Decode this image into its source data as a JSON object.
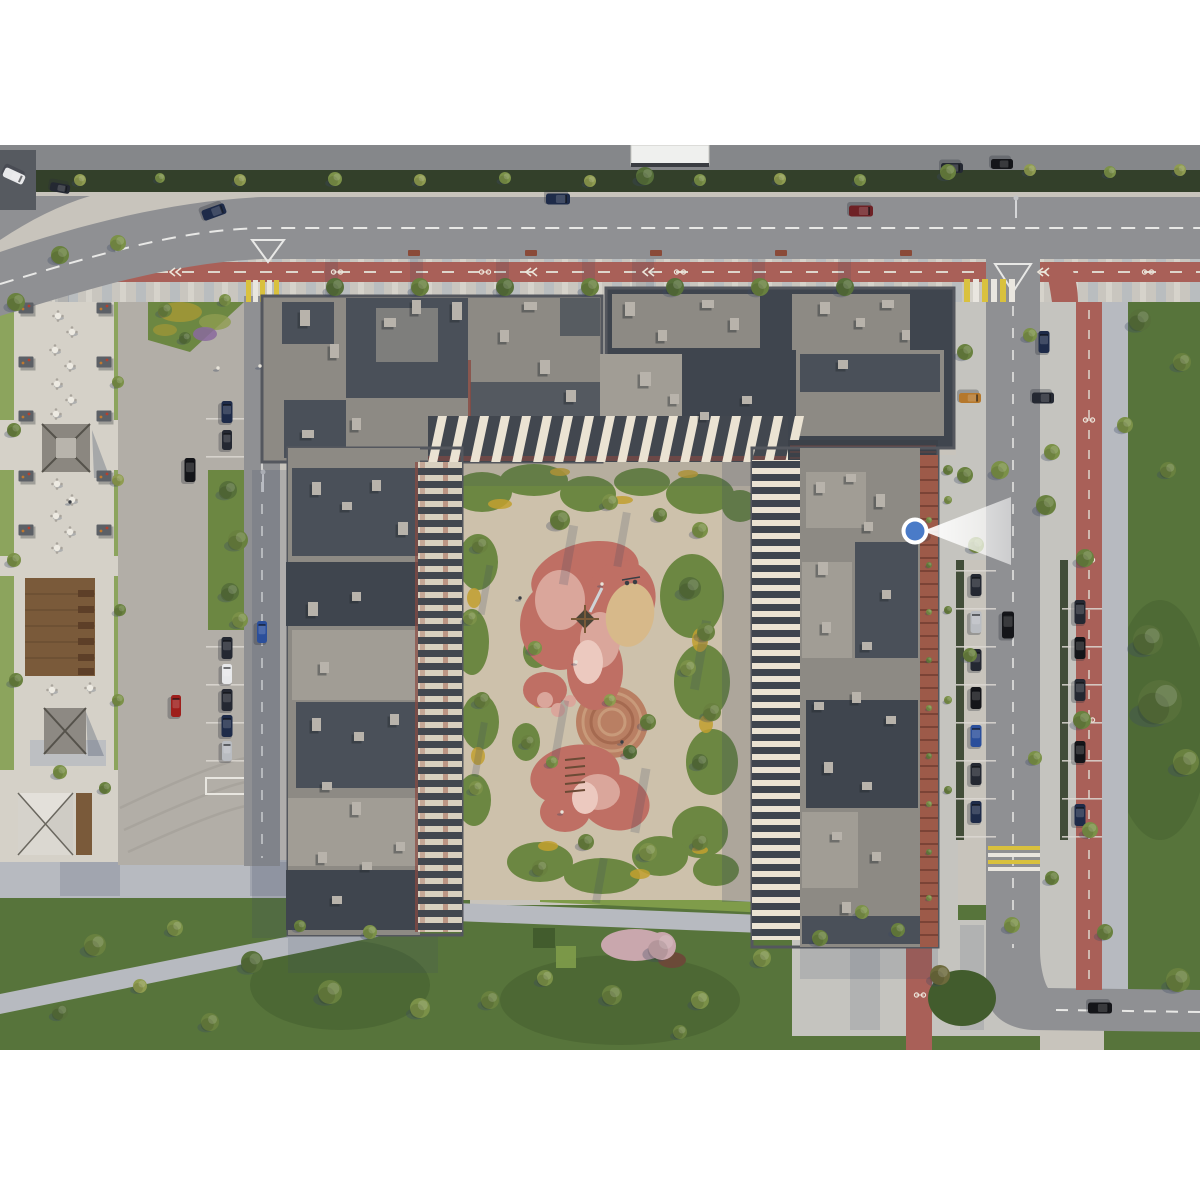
{
  "viewpoint_marker": {
    "x": 915,
    "y": 531,
    "cone_length": 92,
    "color_key": "markerBlue",
    "ring_key": "white"
  },
  "colors": {
    "white": "#ffffff",
    "ground": "#c8c4bc",
    "plaza": "#d5d1c8",
    "apron": "#b2aea7",
    "apronArc": "#a4a099",
    "asphalt": "#8f9093",
    "asphalt2": "#85878a",
    "roadline": "#e8e8e6",
    "stoneA": "#c9c6bf",
    "stoneB": "#b3b9c0",
    "stoneC": "#d6d3cb",
    "stone": "#b7bac0",
    "stoneL": "#c5c4bf",
    "bike": "#a96058",
    "court": "#cdc1ab",
    "lawn": "#57743b",
    "lawn2": "#6c8742",
    "lawnD": "#425c2d",
    "hedge": "#33402a",
    "hedge2": "#7f9c4a",
    "flower": "#c2a02f",
    "purple": "#8a6a9e",
    "blossom": "#c9a7ad",
    "mulch": "#6b4a38",
    "roofA": "#8d8a84",
    "roofD": "#4a5059",
    "roofD2": "#3f454e",
    "roofM": "#a19d95",
    "unit": "#b8b3ab",
    "parapet": "#54575e",
    "cream": "#ebe3d3",
    "facdark": "#42474f",
    "redline": "#8a4a42",
    "brickc": "#9d5a49",
    "brickd": "#7b4336",
    "wood": "#7a5a3a",
    "woodD": "#5d3f28",
    "sand": "#d7b98a",
    "rubber": "#bf6f64",
    "rubberP": "#daa69b",
    "rubberL": "#ecc9bf",
    "circ": "#b97f63",
    "shadow": "#3c4a63",
    "zebraY": "#d9c13e",
    "zebraW": "#e9e6df",
    "markerBlue": "#4a7bc8",
    "carDark": "#242832",
    "carBlack": "#141519",
    "carNavy": "#1e2b49",
    "carBlue": "#2b4f9b",
    "carWhite": "#e7e8ea",
    "carRed": "#9e1f1c",
    "carDkRed": "#6e2125",
    "carSilver": "#b9bcc1",
    "carOrange": "#b5782c",
    "tree1": "#57703a",
    "tree2": "#69813f",
    "tree3": "#7b9148",
    "tree4": "#8f9c50",
    "treeO": "#6d6a3c",
    "bench": "#8a4a38",
    "tableTop": "#edeae2",
    "chair": "#a9a49c",
    "pergola": "#5c6066",
    "person": "#e8e4da"
  },
  "scene": {
    "trees": [
      [
        80,
        180,
        6,
        "tree4"
      ],
      [
        160,
        178,
        5,
        "tree3"
      ],
      [
        240,
        180,
        6,
        "tree4"
      ],
      [
        335,
        179,
        7,
        "tree3"
      ],
      [
        420,
        180,
        6,
        "tree4"
      ],
      [
        505,
        178,
        6,
        "tree3"
      ],
      [
        590,
        181,
        6,
        "tree4"
      ],
      [
        645,
        176,
        9,
        "tree1"
      ],
      [
        700,
        180,
        6,
        "tree3"
      ],
      [
        780,
        179,
        6,
        "tree4"
      ],
      [
        860,
        180,
        6,
        "tree3"
      ],
      [
        948,
        172,
        8,
        "tree2"
      ],
      [
        1030,
        170,
        6,
        "tree4"
      ],
      [
        1110,
        172,
        6,
        "tree3"
      ],
      [
        1180,
        170,
        6,
        "tree4"
      ],
      [
        335,
        287,
        9,
        "tree1"
      ],
      [
        420,
        287,
        9,
        "tree2"
      ],
      [
        505,
        287,
        9,
        "tree1"
      ],
      [
        590,
        287,
        9,
        "tree2"
      ],
      [
        675,
        287,
        9,
        "tree1"
      ],
      [
        760,
        287,
        9,
        "tree2"
      ],
      [
        845,
        287,
        9,
        "tree1"
      ],
      [
        60,
        255,
        9,
        "tree2"
      ],
      [
        118,
        243,
        8,
        "tree3"
      ],
      [
        16,
        302,
        9,
        "tree2"
      ],
      [
        165,
        310,
        7,
        "tree2"
      ],
      [
        225,
        300,
        6,
        "tree3"
      ],
      [
        185,
        338,
        6,
        "tree1"
      ],
      [
        118,
        382,
        6,
        "tree3"
      ],
      [
        14,
        430,
        7,
        "tree2"
      ],
      [
        118,
        480,
        6,
        "tree4"
      ],
      [
        14,
        560,
        7,
        "tree3"
      ],
      [
        120,
        610,
        6,
        "tree2"
      ],
      [
        16,
        680,
        7,
        "tree2"
      ],
      [
        118,
        700,
        6,
        "tree3"
      ],
      [
        60,
        772,
        7,
        "tree3"
      ],
      [
        105,
        788,
        6,
        "tree2"
      ],
      [
        228,
        490,
        9,
        "tree1"
      ],
      [
        238,
        540,
        10,
        "tree2"
      ],
      [
        230,
        592,
        9,
        "tree1"
      ],
      [
        240,
        620,
        8,
        "tree3"
      ],
      [
        965,
        352,
        8,
        "tree2"
      ],
      [
        1030,
        335,
        7,
        "tree3"
      ],
      [
        1140,
        320,
        11,
        "tree1"
      ],
      [
        1182,
        362,
        9,
        "tree2"
      ],
      [
        1125,
        425,
        8,
        "tree3"
      ],
      [
        1168,
        470,
        8,
        "tree2"
      ],
      [
        1046,
        505,
        10,
        "tree2"
      ],
      [
        1052,
        452,
        8,
        "tree3"
      ],
      [
        965,
        475,
        8,
        "tree2"
      ],
      [
        1000,
        470,
        9,
        "tree3"
      ],
      [
        1085,
        558,
        9,
        "tree2"
      ],
      [
        1148,
        640,
        15,
        "tree1"
      ],
      [
        1160,
        702,
        22,
        "tree1"
      ],
      [
        1186,
        762,
        13,
        "tree2"
      ],
      [
        1082,
        720,
        9,
        "tree2"
      ],
      [
        1090,
        830,
        8,
        "tree3"
      ],
      [
        1052,
        878,
        7,
        "tree2"
      ],
      [
        976,
        545,
        8,
        "tree3"
      ],
      [
        970,
        655,
        7,
        "tree2"
      ],
      [
        1035,
        758,
        7,
        "tree3"
      ],
      [
        1178,
        980,
        12,
        "tree2"
      ],
      [
        1012,
        925,
        8,
        "tree3"
      ],
      [
        940,
        975,
        10,
        "treeO"
      ],
      [
        898,
        930,
        7,
        "tree2"
      ],
      [
        1105,
        932,
        8,
        "tree2"
      ],
      [
        862,
        912,
        7,
        "tree3"
      ],
      [
        95,
        945,
        11,
        "tree2"
      ],
      [
        175,
        928,
        8,
        "tree3"
      ],
      [
        252,
        962,
        11,
        "tree1"
      ],
      [
        330,
        992,
        12,
        "tree2"
      ],
      [
        420,
        1008,
        10,
        "tree3"
      ],
      [
        210,
        1022,
        9,
        "tree2"
      ],
      [
        60,
        1012,
        8,
        "tree1"
      ],
      [
        140,
        986,
        7,
        "tree4"
      ],
      [
        370,
        932,
        7,
        "tree3"
      ],
      [
        300,
        926,
        6,
        "tree2"
      ],
      [
        490,
        1000,
        9,
        "tree2"
      ],
      [
        545,
        978,
        8,
        "tree3"
      ],
      [
        612,
        995,
        10,
        "tree2"
      ],
      [
        700,
        1000,
        9,
        "tree3"
      ],
      [
        762,
        958,
        9,
        "tree3"
      ],
      [
        820,
        938,
        8,
        "tree2"
      ],
      [
        680,
        1032,
        7,
        "tree2"
      ],
      [
        662,
        946,
        14,
        "blossom"
      ],
      [
        560,
        520,
        10,
        "tree2"
      ],
      [
        610,
        502,
        8,
        "tree3"
      ],
      [
        660,
        515,
        7,
        "tree2"
      ],
      [
        700,
        530,
        8,
        "tree3"
      ],
      [
        480,
        545,
        8,
        "tree2"
      ],
      [
        470,
        618,
        7,
        "tree3"
      ],
      [
        482,
        700,
        8,
        "tree2"
      ],
      [
        476,
        788,
        7,
        "tree3"
      ],
      [
        690,
        588,
        11,
        "tree1"
      ],
      [
        706,
        632,
        9,
        "tree2"
      ],
      [
        688,
        668,
        8,
        "tree3"
      ],
      [
        712,
        712,
        9,
        "tree2"
      ],
      [
        700,
        762,
        8,
        "tree1"
      ],
      [
        535,
        648,
        7,
        "tree3"
      ],
      [
        528,
        742,
        7,
        "tree2"
      ],
      [
        552,
        762,
        6,
        "tree3"
      ],
      [
        648,
        722,
        8,
        "tree2"
      ],
      [
        630,
        752,
        7,
        "tree1"
      ],
      [
        586,
        842,
        8,
        "tree2"
      ],
      [
        648,
        852,
        9,
        "tree3"
      ],
      [
        540,
        868,
        8,
        "tree2"
      ],
      [
        700,
        842,
        8,
        "tree2"
      ],
      [
        610,
        700,
        6,
        "tree4"
      ],
      [
        929,
        520,
        3,
        "tree3"
      ],
      [
        929,
        565,
        3,
        "tree2"
      ],
      [
        929,
        612,
        3,
        "tree3"
      ],
      [
        929,
        660,
        3,
        "tree2"
      ],
      [
        929,
        708,
        3,
        "tree3"
      ],
      [
        929,
        756,
        3,
        "tree2"
      ],
      [
        929,
        804,
        3,
        "tree3"
      ],
      [
        929,
        852,
        3,
        "tree2"
      ],
      [
        929,
        898,
        3,
        "tree3"
      ],
      [
        948,
        470,
        5,
        "tree2"
      ],
      [
        948,
        500,
        4,
        "tree3"
      ],
      [
        948,
        610,
        4,
        "tree2"
      ],
      [
        948,
        700,
        4,
        "tree3"
      ],
      [
        948,
        790,
        4,
        "tree2"
      ]
    ],
    "cars": [
      [
        558,
        199,
        24,
        11,
        90,
        "carNavy"
      ],
      [
        214,
        212,
        24,
        11,
        70,
        "carNavy"
      ],
      [
        861,
        211,
        24,
        11,
        90,
        "carDkRed"
      ],
      [
        952,
        168,
        22,
        10,
        90,
        "carDark"
      ],
      [
        1002,
        164,
        22,
        10,
        90,
        "carBlack"
      ],
      [
        14,
        176,
        22,
        10,
        115,
        "carWhite"
      ],
      [
        60,
        188,
        20,
        9,
        100,
        "carDark"
      ],
      [
        1008,
        625,
        27,
        12,
        0,
        "carBlack"
      ],
      [
        1044,
        342,
        22,
        11,
        0,
        "carNavy"
      ],
      [
        970,
        398,
        22,
        10,
        90,
        "carOrange"
      ],
      [
        1043,
        398,
        22,
        11,
        90,
        "carDark"
      ],
      [
        976,
        585,
        22,
        11,
        0,
        "carDark"
      ],
      [
        976,
        622,
        22,
        11,
        0,
        "carSilver"
      ],
      [
        976,
        660,
        22,
        11,
        0,
        "carDark"
      ],
      [
        976,
        698,
        22,
        11,
        0,
        "carBlack"
      ],
      [
        976,
        736,
        22,
        11,
        0,
        "carBlue"
      ],
      [
        976,
        774,
        22,
        11,
        0,
        "carDark"
      ],
      [
        976,
        812,
        22,
        11,
        0,
        "carNavy"
      ],
      [
        1080,
        612,
        24,
        11,
        0,
        "carDark"
      ],
      [
        1080,
        648,
        22,
        11,
        0,
        "carBlack"
      ],
      [
        1080,
        690,
        22,
        11,
        0,
        "carDark"
      ],
      [
        1080,
        752,
        22,
        11,
        0,
        "carBlack"
      ],
      [
        1080,
        815,
        22,
        11,
        0,
        "carNavy"
      ],
      [
        1100,
        1008,
        24,
        11,
        90,
        "carBlack"
      ],
      [
        227,
        412,
        22,
        11,
        0,
        "carNavy"
      ],
      [
        227,
        440,
        20,
        10,
        0,
        "carDark"
      ],
      [
        227,
        648,
        22,
        11,
        0,
        "carDark"
      ],
      [
        227,
        674,
        20,
        10,
        0,
        "carWhite"
      ],
      [
        227,
        700,
        22,
        11,
        0,
        "carDark"
      ],
      [
        227,
        726,
        22,
        11,
        0,
        "carNavy"
      ],
      [
        227,
        751,
        20,
        10,
        0,
        "carSilver"
      ],
      [
        176,
        706,
        22,
        10,
        0,
        "carRed"
      ],
      [
        190,
        470,
        24,
        11,
        0,
        "carBlack"
      ],
      [
        262,
        632,
        22,
        10,
        0,
        "carBlue"
      ]
    ],
    "roof_units": [
      [
        300,
        310,
        10,
        16
      ],
      [
        330,
        344,
        9,
        14
      ],
      [
        384,
        318,
        12,
        9
      ],
      [
        412,
        300,
        9,
        14
      ],
      [
        452,
        302,
        10,
        18
      ],
      [
        500,
        330,
        9,
        12
      ],
      [
        524,
        302,
        13,
        8
      ],
      [
        540,
        360,
        10,
        14
      ],
      [
        302,
        430,
        12,
        8
      ],
      [
        352,
        418,
        9,
        12
      ],
      [
        566,
        390,
        10,
        12
      ],
      [
        625,
        302,
        10,
        14
      ],
      [
        658,
        330,
        9,
        11
      ],
      [
        702,
        300,
        12,
        8
      ],
      [
        730,
        318,
        9,
        12
      ],
      [
        640,
        372,
        11,
        14
      ],
      [
        670,
        394,
        9,
        10
      ],
      [
        820,
        302,
        10,
        12
      ],
      [
        856,
        318,
        9,
        9
      ],
      [
        882,
        300,
        12,
        8
      ],
      [
        838,
        360,
        10,
        9
      ],
      [
        700,
        412,
        9,
        8
      ],
      [
        742,
        396,
        10,
        8
      ],
      [
        902,
        330,
        8,
        10
      ],
      [
        312,
        482,
        9,
        13
      ],
      [
        342,
        502,
        10,
        8
      ],
      [
        372,
        480,
        9,
        11
      ],
      [
        398,
        522,
        10,
        13
      ],
      [
        308,
        602,
        10,
        14
      ],
      [
        352,
        592,
        9,
        9
      ],
      [
        320,
        662,
        9,
        11
      ],
      [
        312,
        718,
        9,
        13
      ],
      [
        354,
        732,
        10,
        9
      ],
      [
        390,
        714,
        9,
        11
      ],
      [
        322,
        782,
        10,
        8
      ],
      [
        352,
        802,
        9,
        13
      ],
      [
        318,
        852,
        9,
        11
      ],
      [
        362,
        862,
        10,
        8
      ],
      [
        396,
        842,
        9,
        9
      ],
      [
        332,
        896,
        10,
        8
      ],
      [
        816,
        482,
        9,
        11
      ],
      [
        846,
        474,
        10,
        8
      ],
      [
        876,
        494,
        9,
        13
      ],
      [
        864,
        522,
        9,
        9
      ],
      [
        818,
        562,
        10,
        13
      ],
      [
        882,
        590,
        9,
        9
      ],
      [
        822,
        622,
        9,
        11
      ],
      [
        862,
        642,
        10,
        8
      ],
      [
        814,
        702,
        10,
        8
      ],
      [
        852,
        692,
        9,
        11
      ],
      [
        886,
        716,
        10,
        8
      ],
      [
        824,
        762,
        9,
        11
      ],
      [
        862,
        782,
        10,
        8
      ],
      [
        832,
        832,
        10,
        8
      ],
      [
        872,
        852,
        9,
        9
      ],
      [
        842,
        902,
        9,
        11
      ]
    ],
    "plaza_tables": [
      [
        58,
        316
      ],
      [
        72,
        332
      ],
      [
        55,
        350
      ],
      [
        70,
        366
      ],
      [
        57,
        384
      ],
      [
        71,
        400
      ],
      [
        56,
        414
      ],
      [
        57,
        484
      ],
      [
        72,
        500
      ],
      [
        56,
        516
      ],
      [
        70,
        532
      ],
      [
        57,
        548
      ],
      [
        52,
        690
      ],
      [
        90,
        688
      ]
    ],
    "plaza_pergolas": [
      [
        26,
        308
      ],
      [
        26,
        362
      ],
      [
        26,
        416
      ],
      [
        26,
        476
      ],
      [
        26,
        530
      ],
      [
        104,
        308
      ],
      [
        104,
        362
      ],
      [
        104,
        416
      ],
      [
        104,
        476
      ],
      [
        104,
        530
      ]
    ],
    "deck_benches": [
      [
        78,
        590
      ],
      [
        78,
        606
      ],
      [
        78,
        622
      ],
      [
        78,
        638
      ],
      [
        78,
        654
      ],
      [
        78,
        668
      ]
    ],
    "street_benches": [
      [
        408,
        250
      ],
      [
        525,
        250
      ],
      [
        650,
        250
      ],
      [
        775,
        250
      ],
      [
        900,
        250
      ]
    ],
    "bike_glyphs": [
      [
        337,
        272
      ],
      [
        485,
        272
      ],
      [
        680,
        272
      ],
      [
        1148,
        272
      ],
      [
        1089,
        420
      ],
      [
        1089,
        560
      ],
      [
        1089,
        720
      ],
      [
        920,
        995
      ]
    ],
    "lane_chevrons": [
      [
        172,
        272
      ],
      [
        528,
        272
      ],
      [
        645,
        272
      ],
      [
        1040,
        272
      ]
    ],
    "people": [
      [
        520,
        598
      ],
      [
        602,
        584
      ],
      [
        576,
        662
      ],
      [
        622,
        742
      ],
      [
        562,
        812
      ],
      [
        260,
        366
      ],
      [
        70,
        502
      ],
      [
        218,
        368
      ]
    ]
  }
}
